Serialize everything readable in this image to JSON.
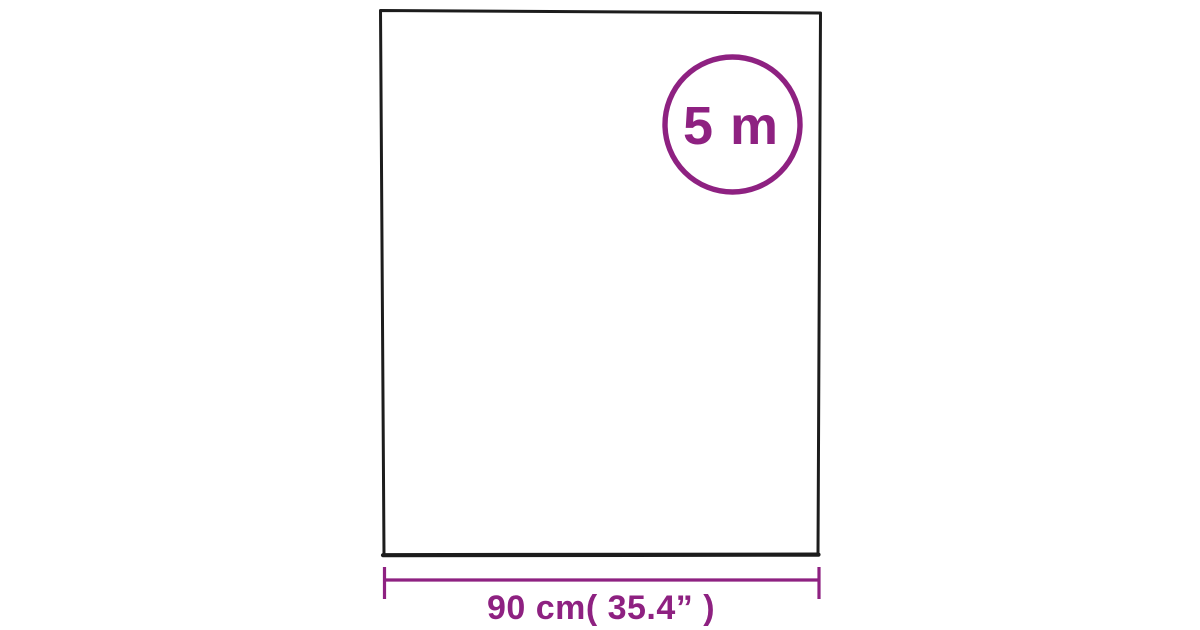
{
  "colors": {
    "background": "#ffffff",
    "outline": "#1c1c1c",
    "accent": "#8e2181"
  },
  "badge": {
    "length_label": "5 m"
  },
  "dimension": {
    "width_label": "90 cm( 35.4” )"
  }
}
